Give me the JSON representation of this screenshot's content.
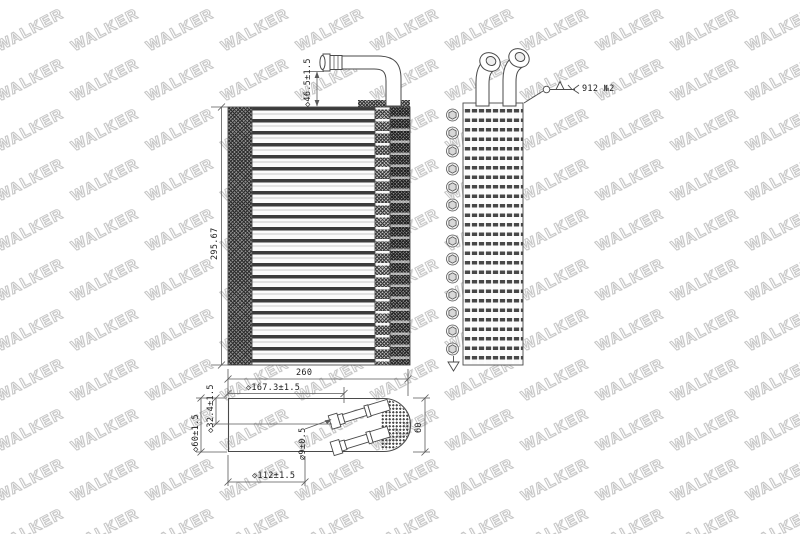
{
  "drawing": {
    "watermark": {
      "text": "WALKER"
    },
    "dimensions": {
      "core_height": "295.67",
      "pipe_stub_height": "◇46.5±1.5",
      "overall_width": "260",
      "pipe_center_167": "◇167.3±1.5",
      "pipe_center_112": "◇112±1.5",
      "depth": "60",
      "depth_tol": "◇60±1.5",
      "pipe_offset_32": "◇32.4±1.5",
      "pipe_dia_9": "⌀9±0.5"
    },
    "notes": {
      "weld_spec": "912 №2"
    },
    "colors": {
      "line": "#4a4a4a",
      "watermark_outline": "#c6c6c6"
    }
  }
}
